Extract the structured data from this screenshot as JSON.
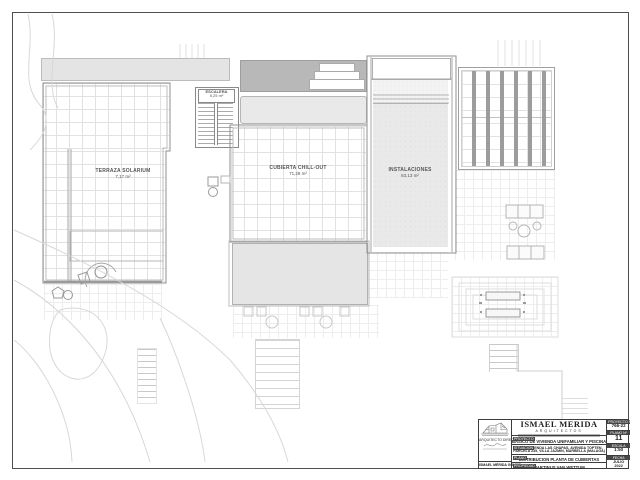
{
  "sheet": {
    "border_color": "#4f4f4f"
  },
  "plan": {
    "rooms": [
      {
        "name": "TERRAZA SOLARIUM",
        "area": "7,17 m²"
      },
      {
        "name": "ESCALERA",
        "area": "5,25 m²"
      },
      {
        "name": "CUBIERTA CHILL-OUT",
        "area": "71,28 m²"
      },
      {
        "name": "INSTALACIONES",
        "area": "83,13 m²"
      }
    ],
    "colors": {
      "wall": "#8f8f8f",
      "grid": "#e2e2e2",
      "roof_band": "#e4e4e4",
      "stair_block": "#b8b8b8",
      "pergola_slat": "#9c9c9c",
      "terrace_fill": "#e5e5e5",
      "pool_fill": "#e9e9e9"
    }
  },
  "title_block": {
    "firm_name": "ISMAEL MERIDA",
    "firm_subtitle": "ARQUITECTOS",
    "architect_caption": "ARQUITECTO DIRECTOR",
    "architect_name": "ISMAEL MÉRIDA GÓMEZ",
    "rows": {
      "proyecto_label": "PROYECTO",
      "proyecto_value": "BASICO DE VIVIENDA UNIFAMILIAR Y PISCINA",
      "situacion_label": "SITUACIÓN",
      "situacion_value_line1": "URB. HACIENDA LAS CHAPAS, AVENIDA TOPTEN,",
      "situacion_value_line2": "PARCELA 235, VILLA JAZMIN, MARBELLA (MALAGA)",
      "plano_label": "PLANO",
      "plano_value": "DISTRIBUCION PLANTA DE CUBIERTAS",
      "propiedad_label": "PROPIEDAD",
      "propiedad_value": "MARTINUS VAN WETTUM"
    },
    "side": {
      "proyecto_no_label": "PROYECTO Nº",
      "proyecto_no": "766-22",
      "plano_no_label": "PLANO Nº",
      "plano_no": "11",
      "escala_label": "ESCALA",
      "escala": "1:50",
      "fecha_label": "FECHA",
      "fecha_line1": "JULIO",
      "fecha_line2": "2022"
    }
  }
}
